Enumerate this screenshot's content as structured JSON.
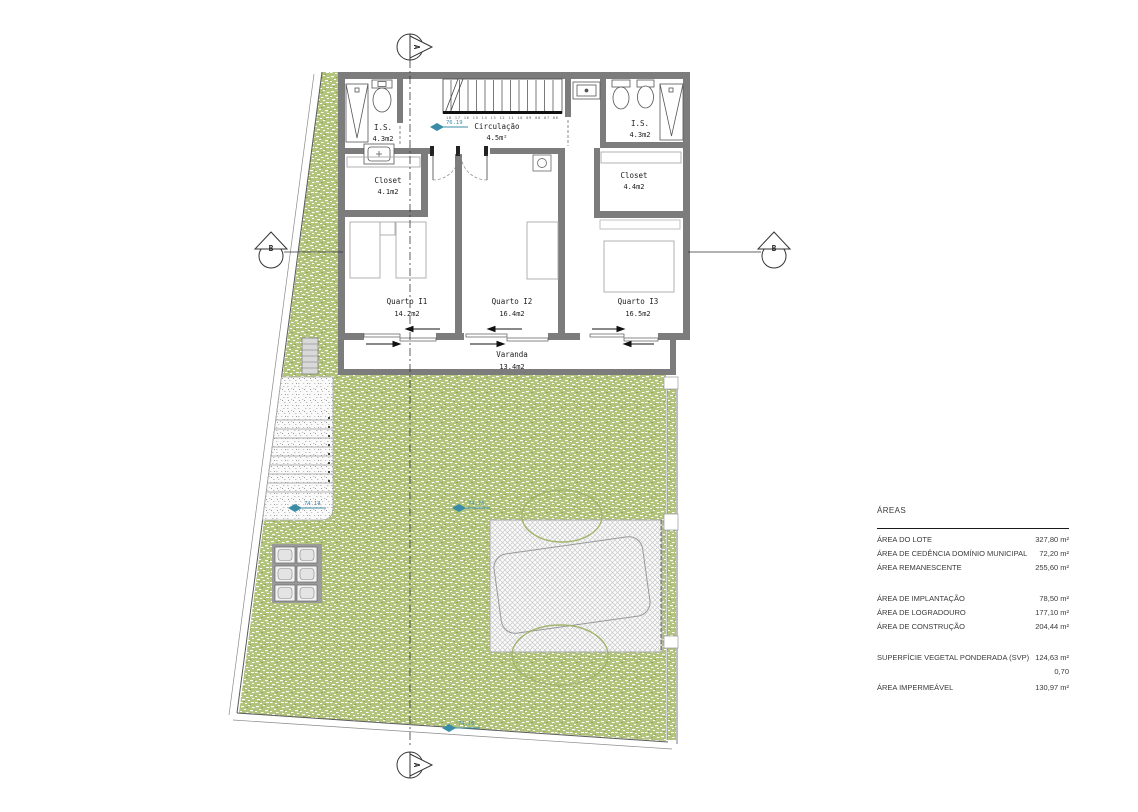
{
  "plan": {
    "rooms": [
      {
        "name": "I.S.",
        "area": "4.3m2"
      },
      {
        "name": "Circulação",
        "area": "4.5m²"
      },
      {
        "name": "I.S.",
        "area": "4.3m2"
      },
      {
        "name": "Closet",
        "area": "4.1m2"
      },
      {
        "name": "Closet",
        "area": "4.4m2"
      },
      {
        "name": "Quarto I1",
        "area": "14.2m2"
      },
      {
        "name": "Quarto I2",
        "area": "16.4m2"
      },
      {
        "name": "Quarto I3",
        "area": "16.5m2"
      },
      {
        "name": "Varanda",
        "area": "13.4m2"
      }
    ],
    "section_markers": {
      "top": "A",
      "bottom": "A",
      "left": "B",
      "right": "B"
    },
    "levels": {
      "circulacao": "76.19",
      "path": "74.14",
      "garden": "74.75",
      "garden_south": "74.10"
    },
    "stair_numbers": "18 17 16 15 14 13 12 11 10 09 08 07 06"
  },
  "areas_table": {
    "title": "ÁREAS",
    "rows": [
      {
        "label": "ÁREA DO LOTE",
        "value": "327,80 m²"
      },
      {
        "label": "ÁREA DE CEDÊNCIA DOMÍNIO MUNICIPAL",
        "value": "72,20 m²"
      },
      {
        "label": "ÁREA REMANESCENTE",
        "value": "255,60 m²"
      },
      {
        "label": "ÁREA DE IMPLANTAÇÃO",
        "value": "78,50 m²"
      },
      {
        "label": "ÁREA DE LOGRADOURO",
        "value": "177,10 m²"
      },
      {
        "label": "ÁREA DE CONSTRUÇÃO",
        "value": "204,44 m²"
      },
      {
        "label": "SUPERFÍCIE VEGETAL PONDERADA (SVP)",
        "value": "124,63 m²"
      },
      {
        "label": "",
        "value": "0,70"
      },
      {
        "label": "ÁREA IMPERMEÁVEL",
        "value": "130,97 m²"
      }
    ]
  },
  "colors": {
    "wall": "#7c7c7c",
    "grass": "#b2c47c",
    "level_marker": "#3a8ca6",
    "hatch": "#c8c8c8"
  }
}
